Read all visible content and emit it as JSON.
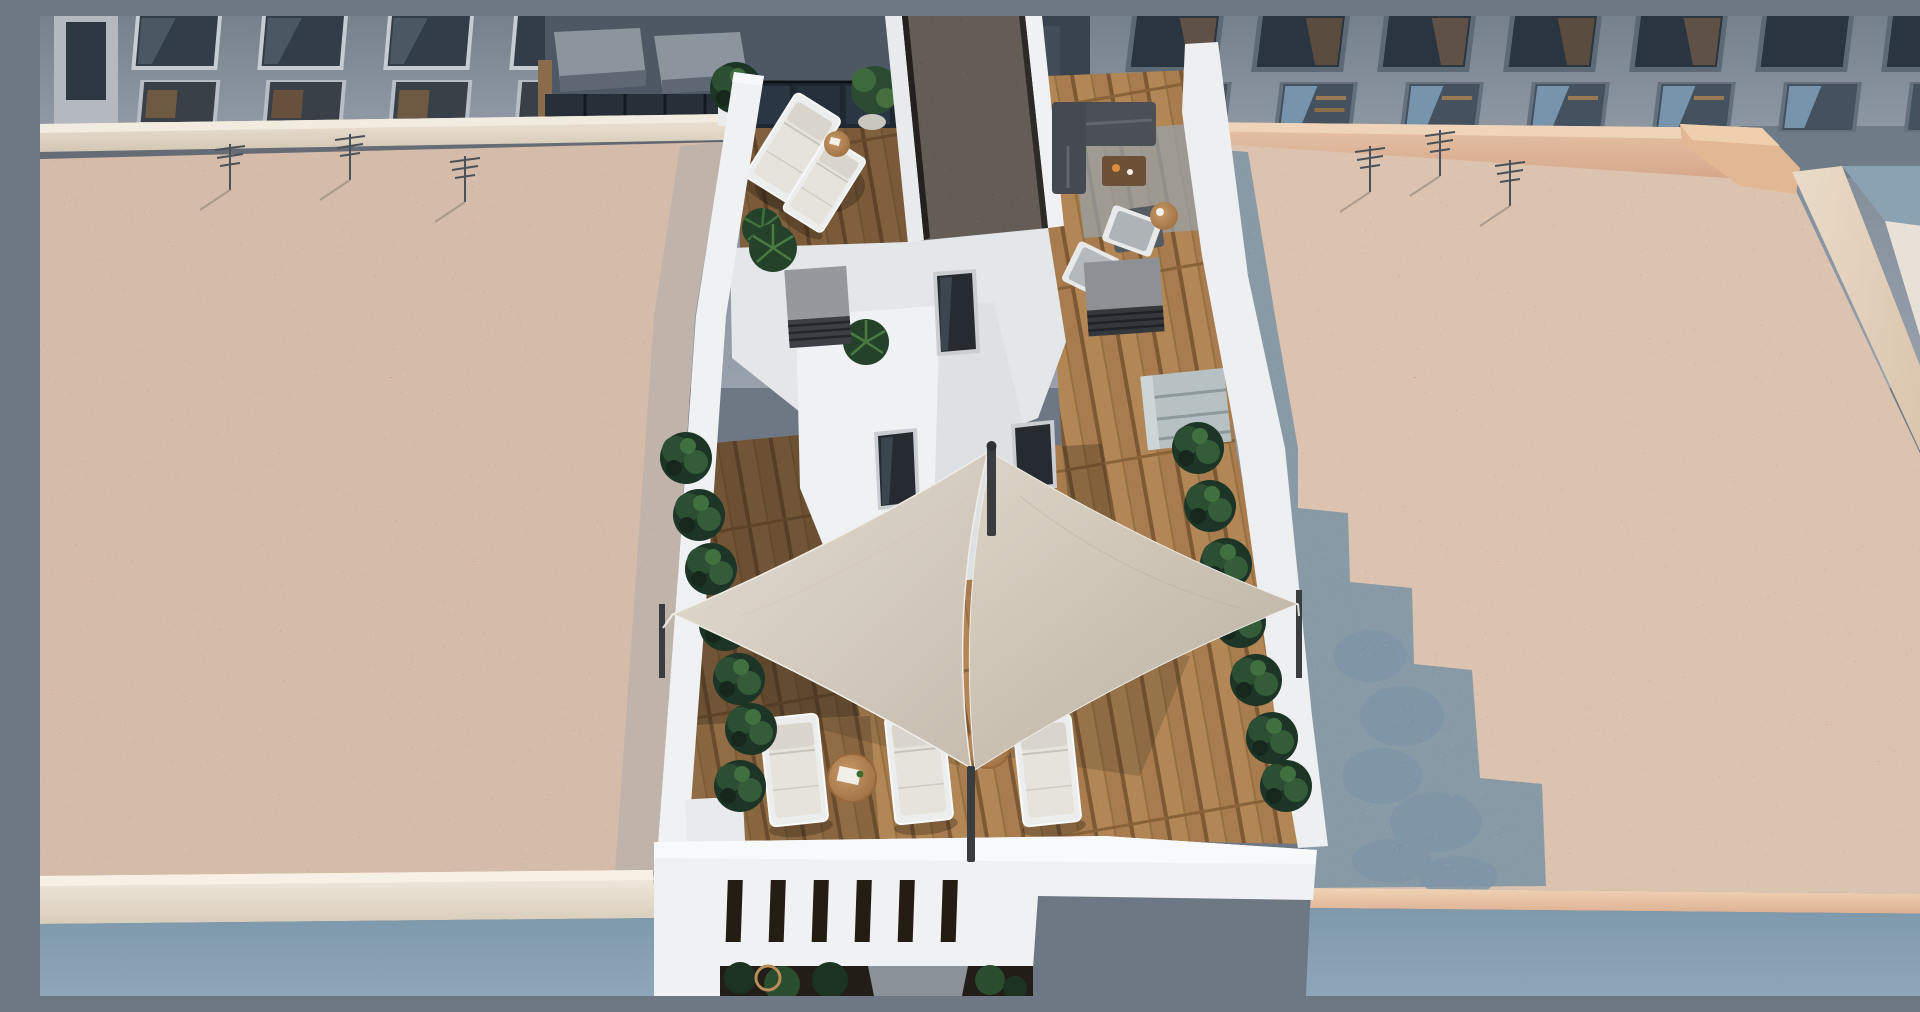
{
  "scene": {
    "title": "Aerial architectural render of a penthouse rooftop terrace with two triangular shade sails, wooden decking, sun loungers and planters, flanked by two flat gravel roofs and neighbouring facades",
    "view": "top-down aerial",
    "setting": "daytime city rooftops",
    "style": "3D architectural visualization"
  },
  "palette": {
    "facade_top": "#76818d",
    "facade_bottom": "#98a1ac",
    "facade_dark": "#4d5864",
    "window_glass": "#2b3540",
    "cream_parapet": "#e9dfd1",
    "peach_parapet": "#e6c3a8",
    "gravel_warm": "#d5bcaa",
    "gravel_warm_right": "#dcc3b0",
    "gravel_shadow_blue": "#7f96a6",
    "gravel_dark_strip": "#645d56",
    "wall_white": "#eff1f2",
    "deck_wood": "#a87c4e",
    "deck_wood_dark": "#55402c",
    "sail_light": "#e3ddd2",
    "sail_dark": "#c6bcae",
    "plant_green": "#27452c",
    "mast_grey": "#3a3d40",
    "street_blue": "#7f99ac"
  },
  "objects": {
    "shade_sails": 2,
    "sail_masts": 2,
    "corner_posts": 2,
    "sun_loungers_main_deck": 4,
    "sun_loungers_upper_terrace": 2,
    "deck_chairs_right_terrace": 2,
    "lounge_sofas": 1,
    "round_side_tables": 4,
    "coffee_tables": 1,
    "outdoor_kitchen_units": 1,
    "ac_units": 2,
    "stair_bulkhead_windows": 3,
    "planter_rows": 2,
    "potted_plants": 4,
    "tv_antennas": 6,
    "pergola_gaps": 6
  },
  "regions": {
    "left": "flat gravel roof with TV antennas",
    "right": "flat gravel roof with stepped blue shadow and plant shadow",
    "center": "penthouse terrace: wood deck, white stair bulkheads, shade sails, loungers, planters",
    "top": "neighbouring grey-blue facades with rows of windows and balconies",
    "bottom": "street-side facades below the roof fascias"
  }
}
